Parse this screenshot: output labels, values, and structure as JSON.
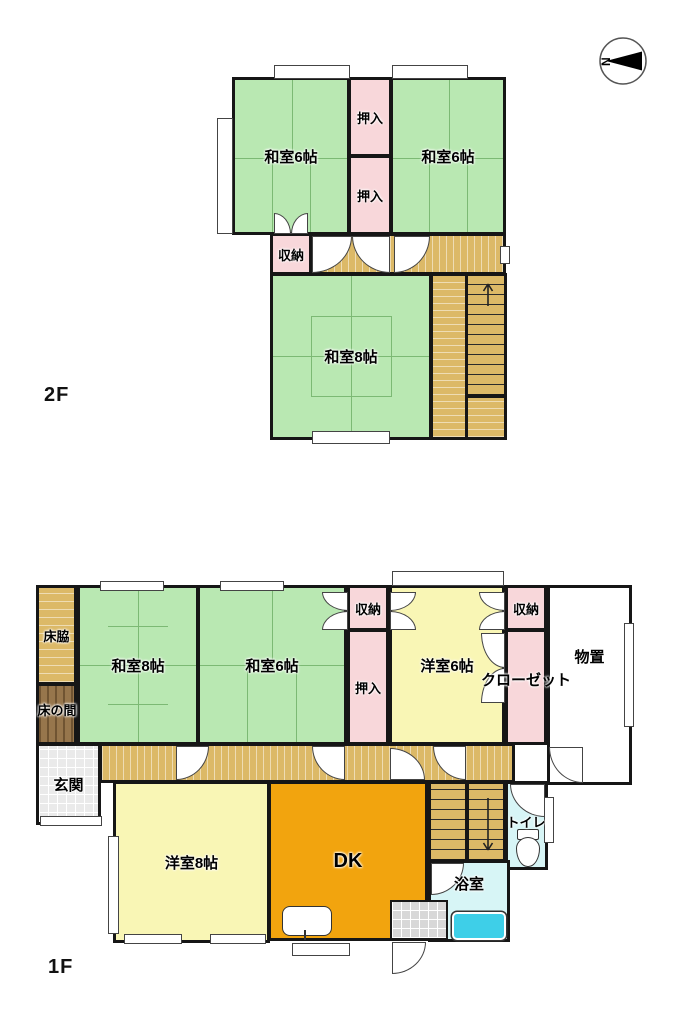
{
  "compass": {
    "north": "N"
  },
  "colors": {
    "tatami_green": "#b9e8b2",
    "closet_pink": "#f8d7da",
    "wood_tan": "#dcb967",
    "western_yellow": "#f9f6b5",
    "dk_orange": "#f2a40e",
    "wet_area_cyan": "#d7f5f6",
    "bathtub_cyan": "#3ecfe8",
    "tokonoma_brown": "#97764c",
    "wall_black": "#161616"
  },
  "floor_2f": {
    "name": "2F",
    "stairs_direction": "up",
    "rooms": {
      "washitsu6_left": "和室6帖",
      "washitsu6_right": "和室6帖",
      "washitsu8": "和室8帖",
      "oshiire_top": "押入",
      "oshiire_mid": "押入",
      "shuno": "収納"
    }
  },
  "floor_1f": {
    "name": "1F",
    "stairs_direction": "down",
    "rooms": {
      "tokowaki": "床脇",
      "tokonoma": "床の間",
      "washitsu8": "和室8帖",
      "washitsu6": "和室6帖",
      "shuno_left": "収納",
      "oshiire": "押入",
      "yoshitsu6": "洋室6帖",
      "shuno_right": "収納",
      "closet": "クローゼット",
      "monooki": "物置",
      "genkan": "玄関",
      "yoshitsu8": "洋室8帖",
      "dk": "DK",
      "toilet": "トイレ",
      "bath": "浴室"
    }
  }
}
